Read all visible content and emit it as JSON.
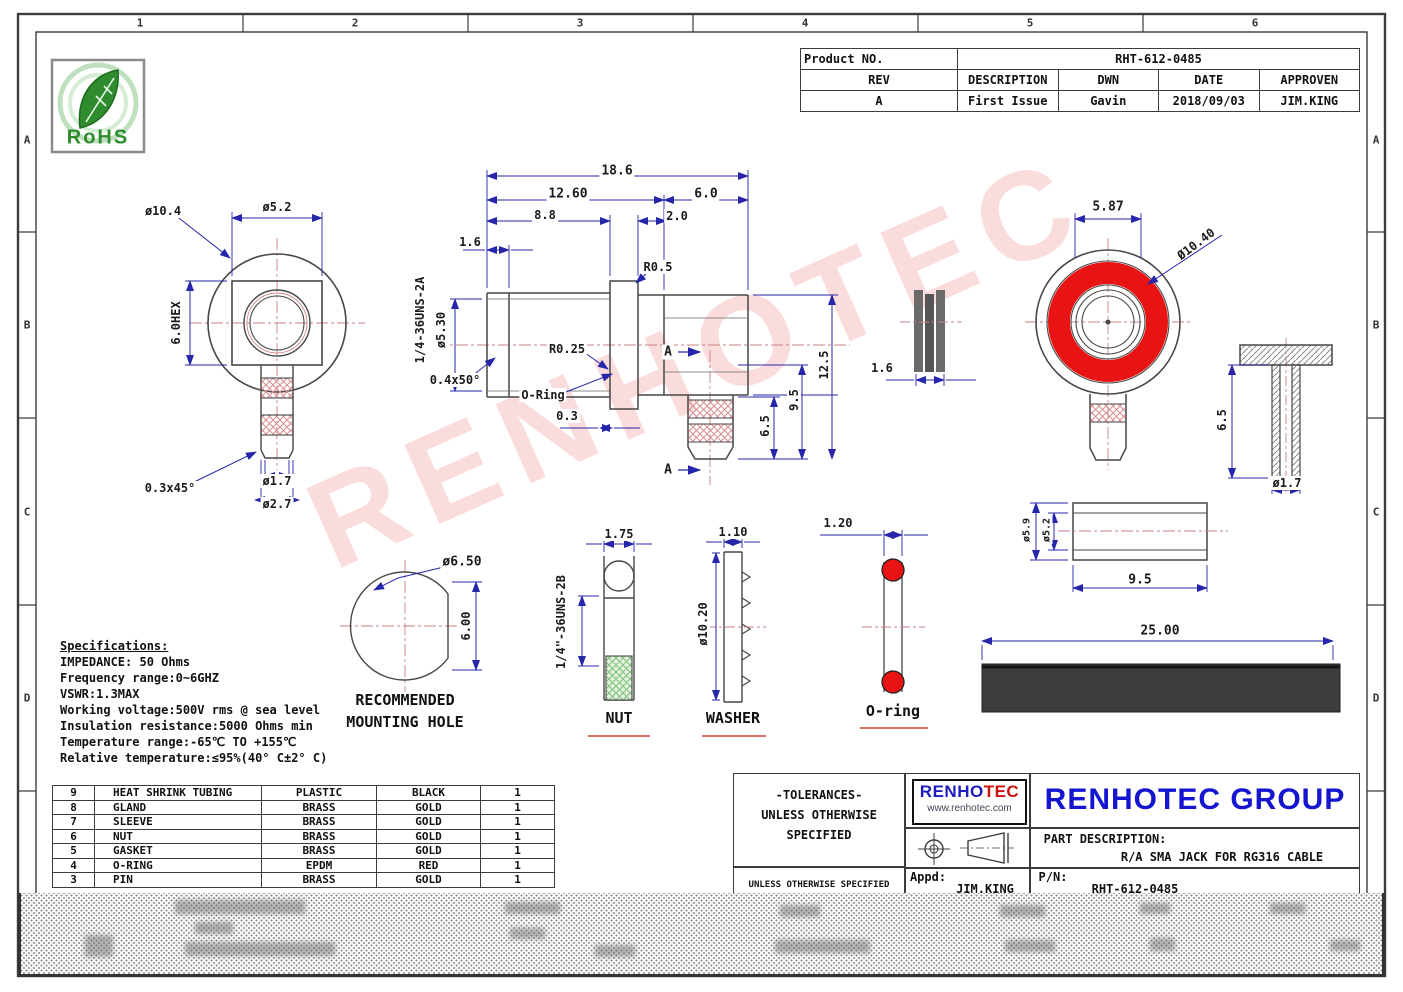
{
  "frame": {
    "top_labels": [
      "1",
      "2",
      "3",
      "4",
      "5",
      "6"
    ],
    "side_labels": [
      "A",
      "B",
      "C",
      "D"
    ]
  },
  "rohs_label": "RoHS",
  "watermark": "RENHOTEC",
  "product_block": {
    "label": "Product NO.",
    "number": "RHT-612-0485",
    "headers": [
      "REV",
      "DESCRIPTION",
      "DWN",
      "DATE",
      "APPROVEN"
    ],
    "row": [
      "A",
      "First Issue",
      "Gavin",
      "2018/09/03",
      "JIM.KING"
    ]
  },
  "dims": {
    "front": {
      "phi10_4": "ø10.4",
      "phi5_2": "ø5.2",
      "hex6_0": "6.0HEX",
      "chamfer": "0.3x45°",
      "phi1_7": "ø1.7",
      "phi2_7": "ø2.7"
    },
    "side": {
      "d18_6": "18.6",
      "d12_60": "12.60",
      "d6_0": "6.0",
      "d8_8": "8.8",
      "d2_0": "2.0",
      "d1_6": "1.6",
      "thread": "1/4-36UNS-2A",
      "phi5_30": "ø5.30",
      "r0_5": "R0.5",
      "r0_25": "R0.25",
      "ch0_4": "0.4x50°",
      "oring": "O-Ring",
      "d0_3": "0.3",
      "a_top": "A",
      "a_bot": "A",
      "d6_5": "6.5",
      "d9_5": "9.5",
      "d12_5": "12.5"
    },
    "gasket_small": {
      "d1_6": "1.6"
    },
    "red_front": {
      "d5_87": "5.87",
      "phi10_40": "Ø10.40"
    },
    "pin": {
      "d6_5": "6.5",
      "phi1_7": "ø1.7"
    },
    "gasket_tube": {
      "phi5_9": "ø5.9",
      "phi5_2": "ø5.2",
      "d9_5": "9.5"
    },
    "mount": {
      "phi6_50": "ø6.50",
      "d6_00": "6.00",
      "cap1": "RECOMMENDED",
      "cap2": "MOUNTING HOLE"
    },
    "nut": {
      "d1_75": "1.75",
      "thread": "1/4\"-36UNS-2B",
      "caption": "NUT"
    },
    "washer": {
      "d1_10": "1.10",
      "phi10_20": "ø10.20",
      "caption": "WASHER"
    },
    "oring": {
      "d1_20": "1.20",
      "caption": "O-ring"
    },
    "heatshrink": {
      "d25_00": "25.00"
    }
  },
  "specs": {
    "title": "Specifications:",
    "lines": [
      "IMPEDANCE: 50 Ohms",
      "Frequency range:0~6GHZ",
      "VSWR:1.3MAX",
      "Working voltage:500V rms @ sea level",
      "Insulation resistance:5000 Ohms min",
      "Temperature range:-65℃ TO +155℃",
      "Relative temperature:≤95%(40° C±2° C)"
    ]
  },
  "bom": {
    "rows": [
      [
        "9",
        "HEAT SHRINK TUBING",
        "PLASTIC",
        "BLACK",
        "1"
      ],
      [
        "8",
        "GLAND",
        "BRASS",
        "GOLD",
        "1"
      ],
      [
        "7",
        "SLEEVE",
        "BRASS",
        "GOLD",
        "1"
      ],
      [
        "6",
        "NUT",
        "BRASS",
        "GOLD",
        "1"
      ],
      [
        "5",
        "GASKET",
        "BRASS",
        "GOLD",
        "1"
      ],
      [
        "4",
        "O-RING",
        "EPDM",
        "RED",
        "1"
      ],
      [
        "3",
        "PIN",
        "BRASS",
        "GOLD",
        "1"
      ]
    ]
  },
  "title_block": {
    "tol1": "-TOLERANCES-",
    "tol2": "UNLESS OTHERWISE",
    "tol3": "SPECIFIED",
    "tol_small": "UNLESS OTHERWISE SPECIFIED",
    "logo_main_1": "RENHO",
    "logo_main_2": "TEC",
    "logo_site": "www.renhotec.com",
    "appd_label": "Appd:",
    "appd_value": "JIM.KING",
    "company": "RENHOTEC GROUP",
    "part_desc_label": "PART DESCRIPTION:",
    "part_desc": "R/A SMA JACK FOR RG316 CABLE",
    "pn_label": "P/N:",
    "pn": "RHT-612-0485"
  },
  "colors": {
    "accent_red": "#e81313",
    "dim_blue": "#2626aa",
    "brand_blue": "#1515cf",
    "rohs_green": "#2e8b2e"
  }
}
